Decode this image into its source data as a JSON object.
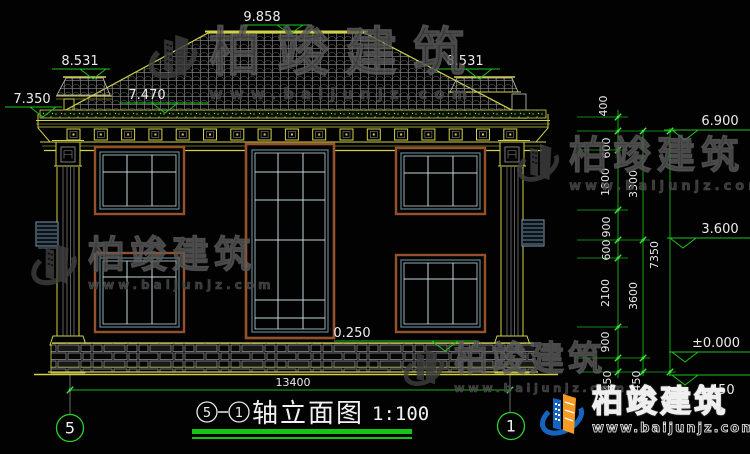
{
  "brand": {
    "name": "柏竣建筑",
    "url": "www.baijunjz.com"
  },
  "levels": {
    "ridge": "9.858",
    "upper_left": "8.531",
    "upper_right": "8.531",
    "eave_left": "7.350",
    "eave_mid": "7.470",
    "floor_top": "6.900",
    "floor_mid": "3.600",
    "floor_zero": "±0.000",
    "ground": "0.450",
    "plinth": "0.250"
  },
  "dims": {
    "total_width": "13400",
    "overall_height": "7350",
    "chain": [
      "400",
      "600",
      "1800",
      "900",
      "600",
      "2100",
      "900",
      "450"
    ],
    "floors": [
      "3300",
      "3600",
      "450"
    ]
  },
  "grid_bubbles": {
    "left": "5",
    "right": "1"
  },
  "title": {
    "axis_left": "5",
    "axis_right": "1",
    "text": "轴立面图",
    "scale": "1:100"
  }
}
